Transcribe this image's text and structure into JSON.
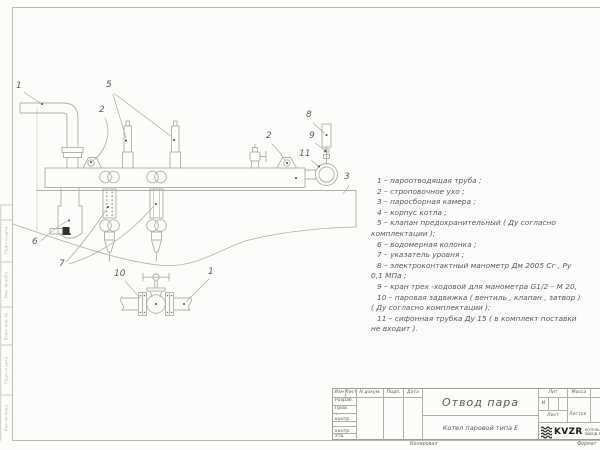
{
  "drawing": {
    "callouts": {
      "steam_pipe": "1",
      "safety_valves": "5",
      "lug_left": "2",
      "lug_right": "2",
      "manometer": "8",
      "three_way_cock": "9",
      "siphon_tube": "11",
      "steam_chamber": "3",
      "water_column": "6",
      "level_gauge": "7",
      "steam_valve": "10",
      "pipe_bottom": "1"
    }
  },
  "legend": {
    "lines": [
      "1 –  пароотводящая труба ;",
      "2 –  строповочное ухо ;",
      "3 –  паросборная камера ;",
      "4 –  корпус котла ;",
      "5 –  клапан предохранительный  ( Ду согласно",
      "комплектации );",
      "6 –  водомерная колонка ;",
      "7 – указатель уровня ;",
      "8 – электроконтактный манометр  Дм 2005 Сг ,  Ру",
      "0,1  МПа ;",
      "9 –  кран трех -ходовой для манометра  G1/2 – М 20,",
      "10 –  паровая задвижка  ( вентиль , клапан , затвор )",
      "( Ду согласно комплектации );",
      "11 –  сифонная трубка Ду 15 ( в комплект поставки",
      "не входит )."
    ]
  },
  "titleblock": {
    "cols": {
      "izm": "Изм",
      "list": "Лист",
      "ndok": "N докум.",
      "podp": "Подп.",
      "data": "Дата"
    },
    "rows": [
      "Разраб.",
      "Пров.",
      "Т. контр.",
      "Н. контр.",
      "Утв."
    ],
    "title": "Отвод пара",
    "subtitle": "Котел паровой типа Е",
    "lit_header": "Лит",
    "massa_header": "Масса",
    "masshtab_header": "Масштаб",
    "lit_value": "И",
    "list_label": "Лист",
    "listov_label": "Листов",
    "org_name": "KVZR",
    "org_line1": "КОТЕЛЬНЫЙ",
    "org_line2": "ЗАВОД РО"
  },
  "margin": {
    "labels": [
      "Подп. и дата",
      "Инв. № дубл.",
      "Взам. инв. №",
      "Подп. и дата",
      "Инв. № подл."
    ]
  },
  "footer": {
    "kopiroval": "Копировал",
    "format": "Формат"
  },
  "colors": {
    "line": "#b3ada4",
    "faint_line": "#cfcac2",
    "text": "#5c5a57",
    "marker": "#454545"
  }
}
